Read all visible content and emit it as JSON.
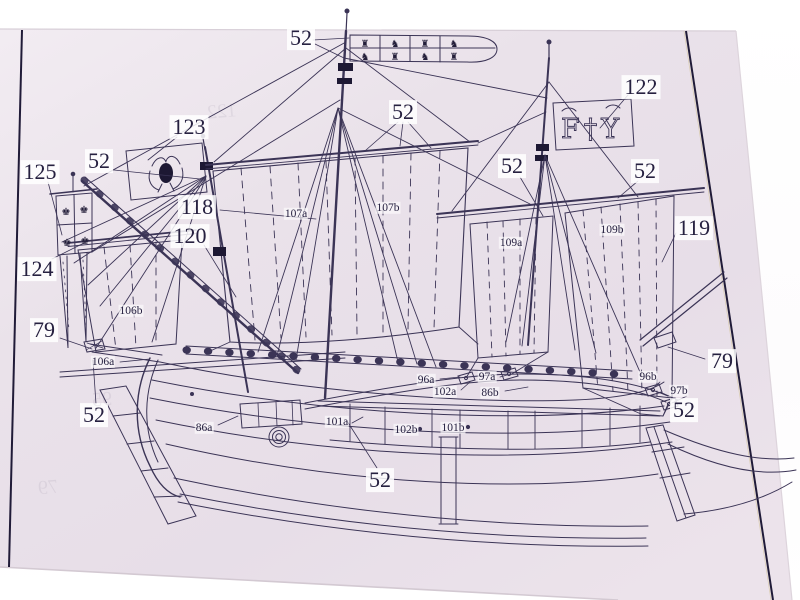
{
  "scene": {
    "description": "Photograph of a printed ship model plan sheet (caravel side elevation with numbered parts) lying on a white surface",
    "paper_color": "#eae2ea",
    "ink_color": "#3b3456",
    "frame_color": "#201b38",
    "label_text_color": "#262040"
  },
  "diagram": {
    "part_labels": [
      {
        "text": "52",
        "x": 301,
        "y": 38,
        "size": "large"
      },
      {
        "text": "122",
        "x": 641,
        "y": 87,
        "size": "large"
      },
      {
        "text": "52",
        "x": 403,
        "y": 112,
        "size": "large"
      },
      {
        "text": "123",
        "x": 189,
        "y": 127,
        "size": "large"
      },
      {
        "text": "52",
        "x": 99,
        "y": 161,
        "size": "large"
      },
      {
        "text": "125",
        "x": 40,
        "y": 172,
        "size": "large"
      },
      {
        "text": "52",
        "x": 512,
        "y": 166,
        "size": "large"
      },
      {
        "text": "52",
        "x": 645,
        "y": 171,
        "size": "large"
      },
      {
        "text": "118",
        "x": 197,
        "y": 207,
        "size": "large"
      },
      {
        "text": "119",
        "x": 694,
        "y": 228,
        "size": "large"
      },
      {
        "text": "120",
        "x": 190,
        "y": 236,
        "size": "large"
      },
      {
        "text": "124",
        "x": 37,
        "y": 269,
        "size": "large"
      },
      {
        "text": "79",
        "x": 44,
        "y": 330,
        "size": "large"
      },
      {
        "text": "79",
        "x": 722,
        "y": 361,
        "size": "large"
      },
      {
        "text": "52",
        "x": 94,
        "y": 415,
        "size": "large"
      },
      {
        "text": "52",
        "x": 684,
        "y": 410,
        "size": "large"
      },
      {
        "text": "52",
        "x": 380,
        "y": 480,
        "size": "large"
      },
      {
        "text": "107a",
        "x": 296,
        "y": 214,
        "size": "small"
      },
      {
        "text": "107b",
        "x": 388,
        "y": 208,
        "size": "small"
      },
      {
        "text": "109a",
        "x": 511,
        "y": 243,
        "size": "small"
      },
      {
        "text": "109b",
        "x": 612,
        "y": 230,
        "size": "small"
      },
      {
        "text": "106b",
        "x": 131,
        "y": 311,
        "size": "small"
      },
      {
        "text": "106a",
        "x": 103,
        "y": 362,
        "size": "small"
      },
      {
        "text": "96a",
        "x": 426,
        "y": 380,
        "size": "small"
      },
      {
        "text": "97a",
        "x": 487,
        "y": 377,
        "size": "small"
      },
      {
        "text": "102a",
        "x": 445,
        "y": 392,
        "size": "small"
      },
      {
        "text": "86b",
        "x": 490,
        "y": 393,
        "size": "small"
      },
      {
        "text": "96b",
        "x": 648,
        "y": 377,
        "size": "small"
      },
      {
        "text": "97b",
        "x": 679,
        "y": 391,
        "size": "small"
      },
      {
        "text": "86a",
        "x": 204,
        "y": 428,
        "size": "small"
      },
      {
        "text": "101a",
        "x": 337,
        "y": 422,
        "size": "small"
      },
      {
        "text": "102b",
        "x": 406,
        "y": 430,
        "size": "small"
      },
      {
        "text": "101b",
        "x": 453,
        "y": 428,
        "size": "small"
      }
    ],
    "ghost_labels": [
      {
        "text": "122",
        "x": 222,
        "y": 112
      },
      {
        "text": "95",
        "x": 102,
        "y": 400
      },
      {
        "text": "79",
        "x": 48,
        "y": 488
      }
    ],
    "flags": {
      "royal_standard": {
        "symbols": [
          "♜",
          "♞",
          "♜",
          "♞",
          "♞",
          "♜",
          "♞",
          "♜"
        ]
      },
      "fy_flag": {
        "text": "F†Y"
      },
      "crown_banner": {
        "symbols": [
          "♚",
          "♚",
          "♚",
          "♚"
        ]
      }
    }
  }
}
